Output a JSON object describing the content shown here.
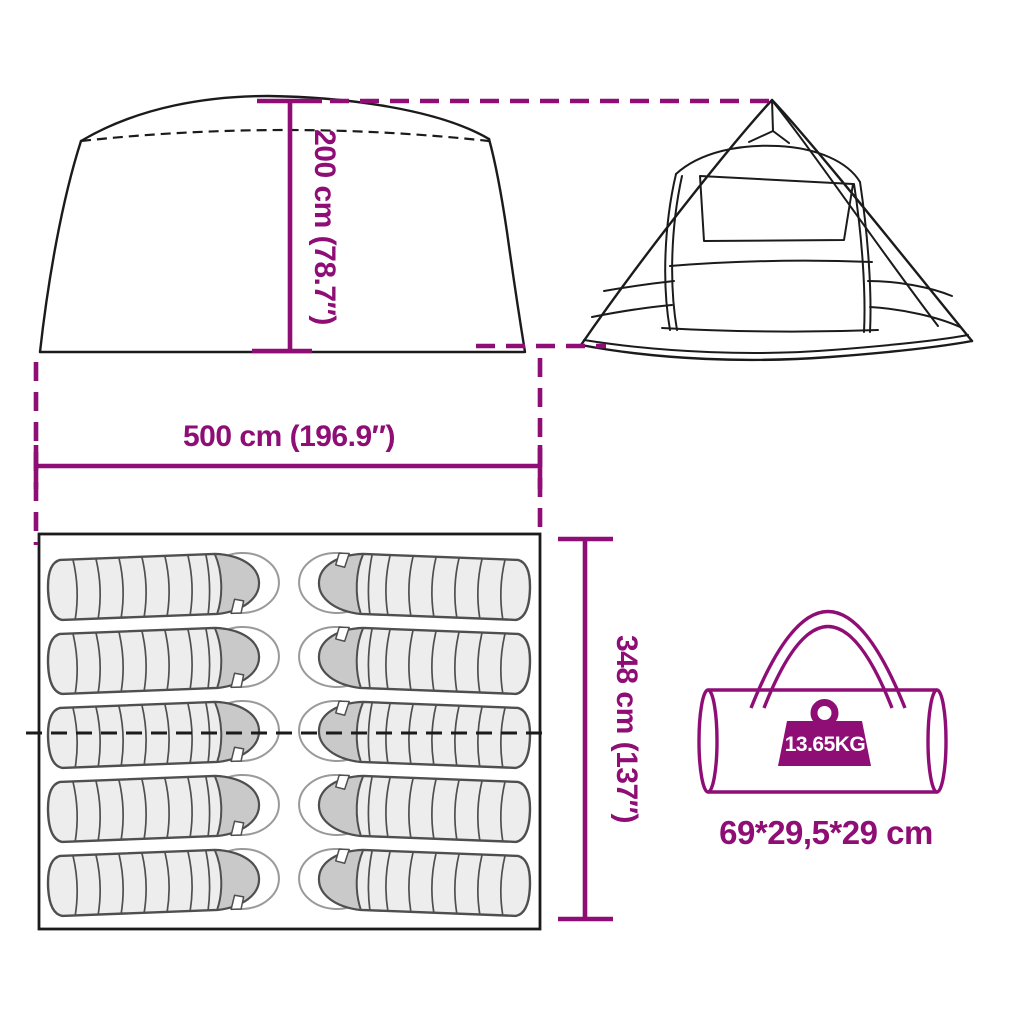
{
  "colors": {
    "accent": "#8E0E76",
    "line": "#1B1B1B",
    "bag_fill": "#ededed",
    "bag_hood": "#c9c9c9"
  },
  "dimensions": {
    "height_label": "200 cm (78.7″)",
    "width_label": "500 cm (196.9″)",
    "depth_label": "348 cm (137″)"
  },
  "carry_bag": {
    "weight_label": "13.65KG",
    "size_label": "69*29,5*29 cm"
  },
  "floorplan": {
    "sleeping_bag_count": 10,
    "rows": 5,
    "columns": 2
  },
  "icons": {
    "front": "tent-front-silhouette",
    "side": "tent-side-silhouette",
    "floorplan": "tent-floorplan",
    "sleeping_bag": "sleeping-bag-icon",
    "carry_bag": "carry-bag-icon",
    "weight": "weight-icon"
  }
}
